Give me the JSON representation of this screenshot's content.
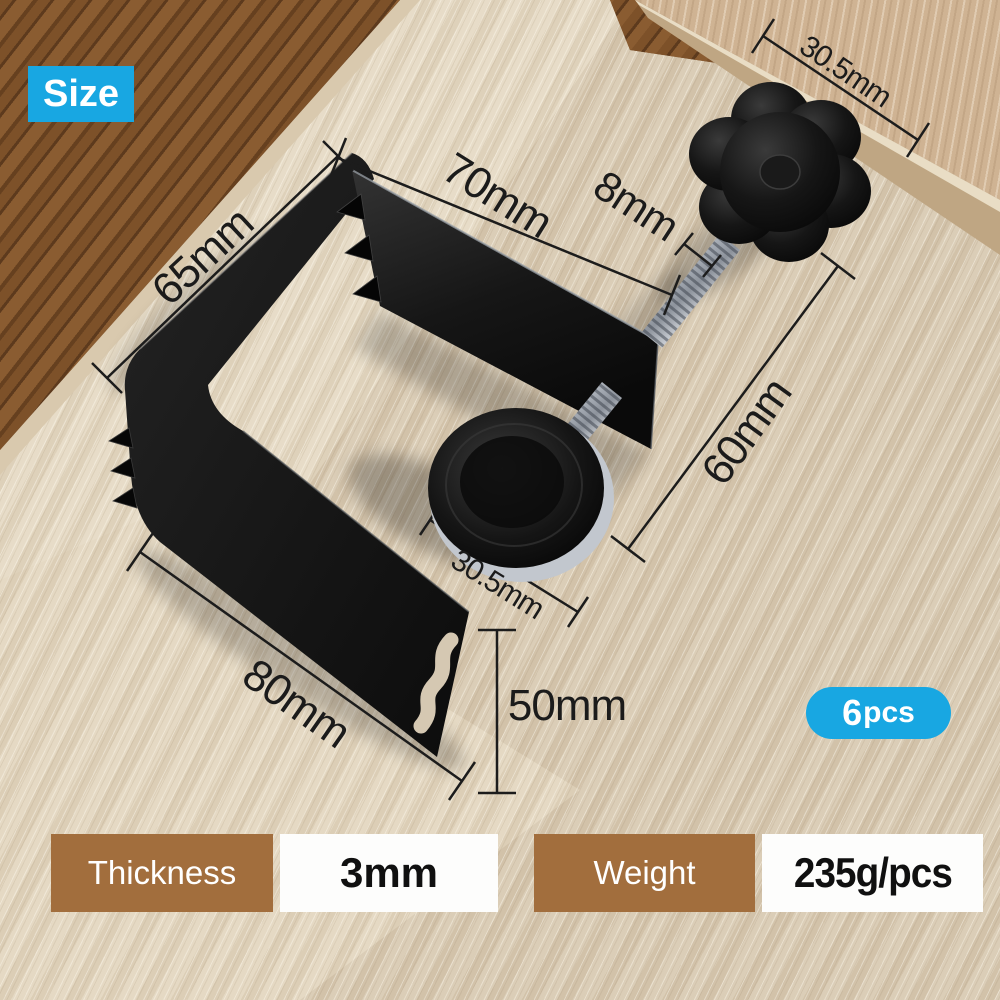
{
  "badges": {
    "size": "Size",
    "pack_count": "6",
    "pack_unit": "pcs"
  },
  "dimensions": {
    "block_width": "30.5mm",
    "clamp_width": "70mm",
    "screw_diameter": "8mm",
    "clamp_depth": "65mm",
    "screw_length": "60mm",
    "pad_diameter": "30.5mm",
    "base_length": "80mm",
    "slot_height": "50mm"
  },
  "spec_bar": {
    "thickness_label": "Thickness",
    "thickness_value": "3mm",
    "weight_label": "Weight",
    "weight_value": "235g/pcs"
  },
  "colors": {
    "accent_blue": "#18a7e2",
    "label_brown": "#a26e3d",
    "dimension_ink": "#1b1b1b",
    "clamp_black": "#141414",
    "steel_silver": "#c9ced6"
  }
}
